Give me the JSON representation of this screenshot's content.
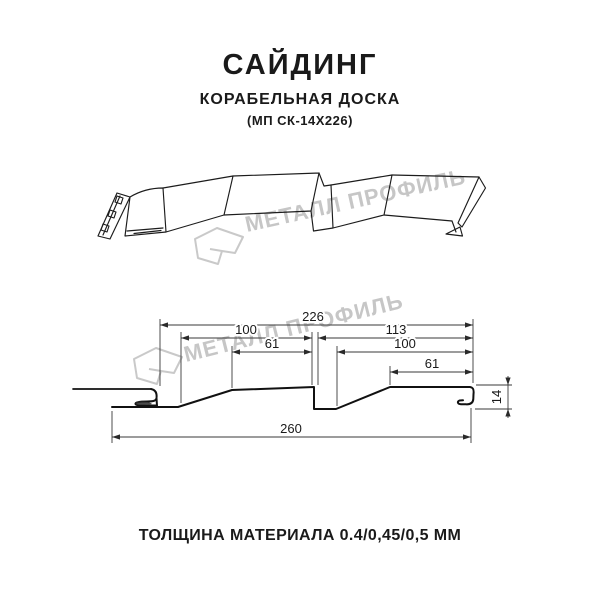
{
  "header": {
    "title": "САЙДИНГ",
    "subtitle": "КОРАБЕЛЬНАЯ ДОСКА",
    "model": "(МП СК-14Х226)"
  },
  "footer": {
    "text": "ТОЛЩИНА МАТЕРИАЛА 0.4/0,45/0,5 ММ"
  },
  "watermark": {
    "text": "МЕТАЛЛ ПРОФИЛЬ",
    "logo": "metall-profil-logo",
    "color": "#c6c6c6"
  },
  "drawing": {
    "name": "Сайдинг Корабельная Доска — профиль МП СК-14Х226",
    "dims": {
      "total_top": "226",
      "pitch_left": "100",
      "pitch_right": "113",
      "flat_left": "61",
      "inner_right": "100",
      "flat_right": "61",
      "depth": "14",
      "overall_bottom": "260"
    }
  },
  "colors": {
    "background": "#ffffff",
    "line": "#1c1c1c",
    "dimension": "#3a3a3a",
    "watermark": "#c6c6c6"
  }
}
